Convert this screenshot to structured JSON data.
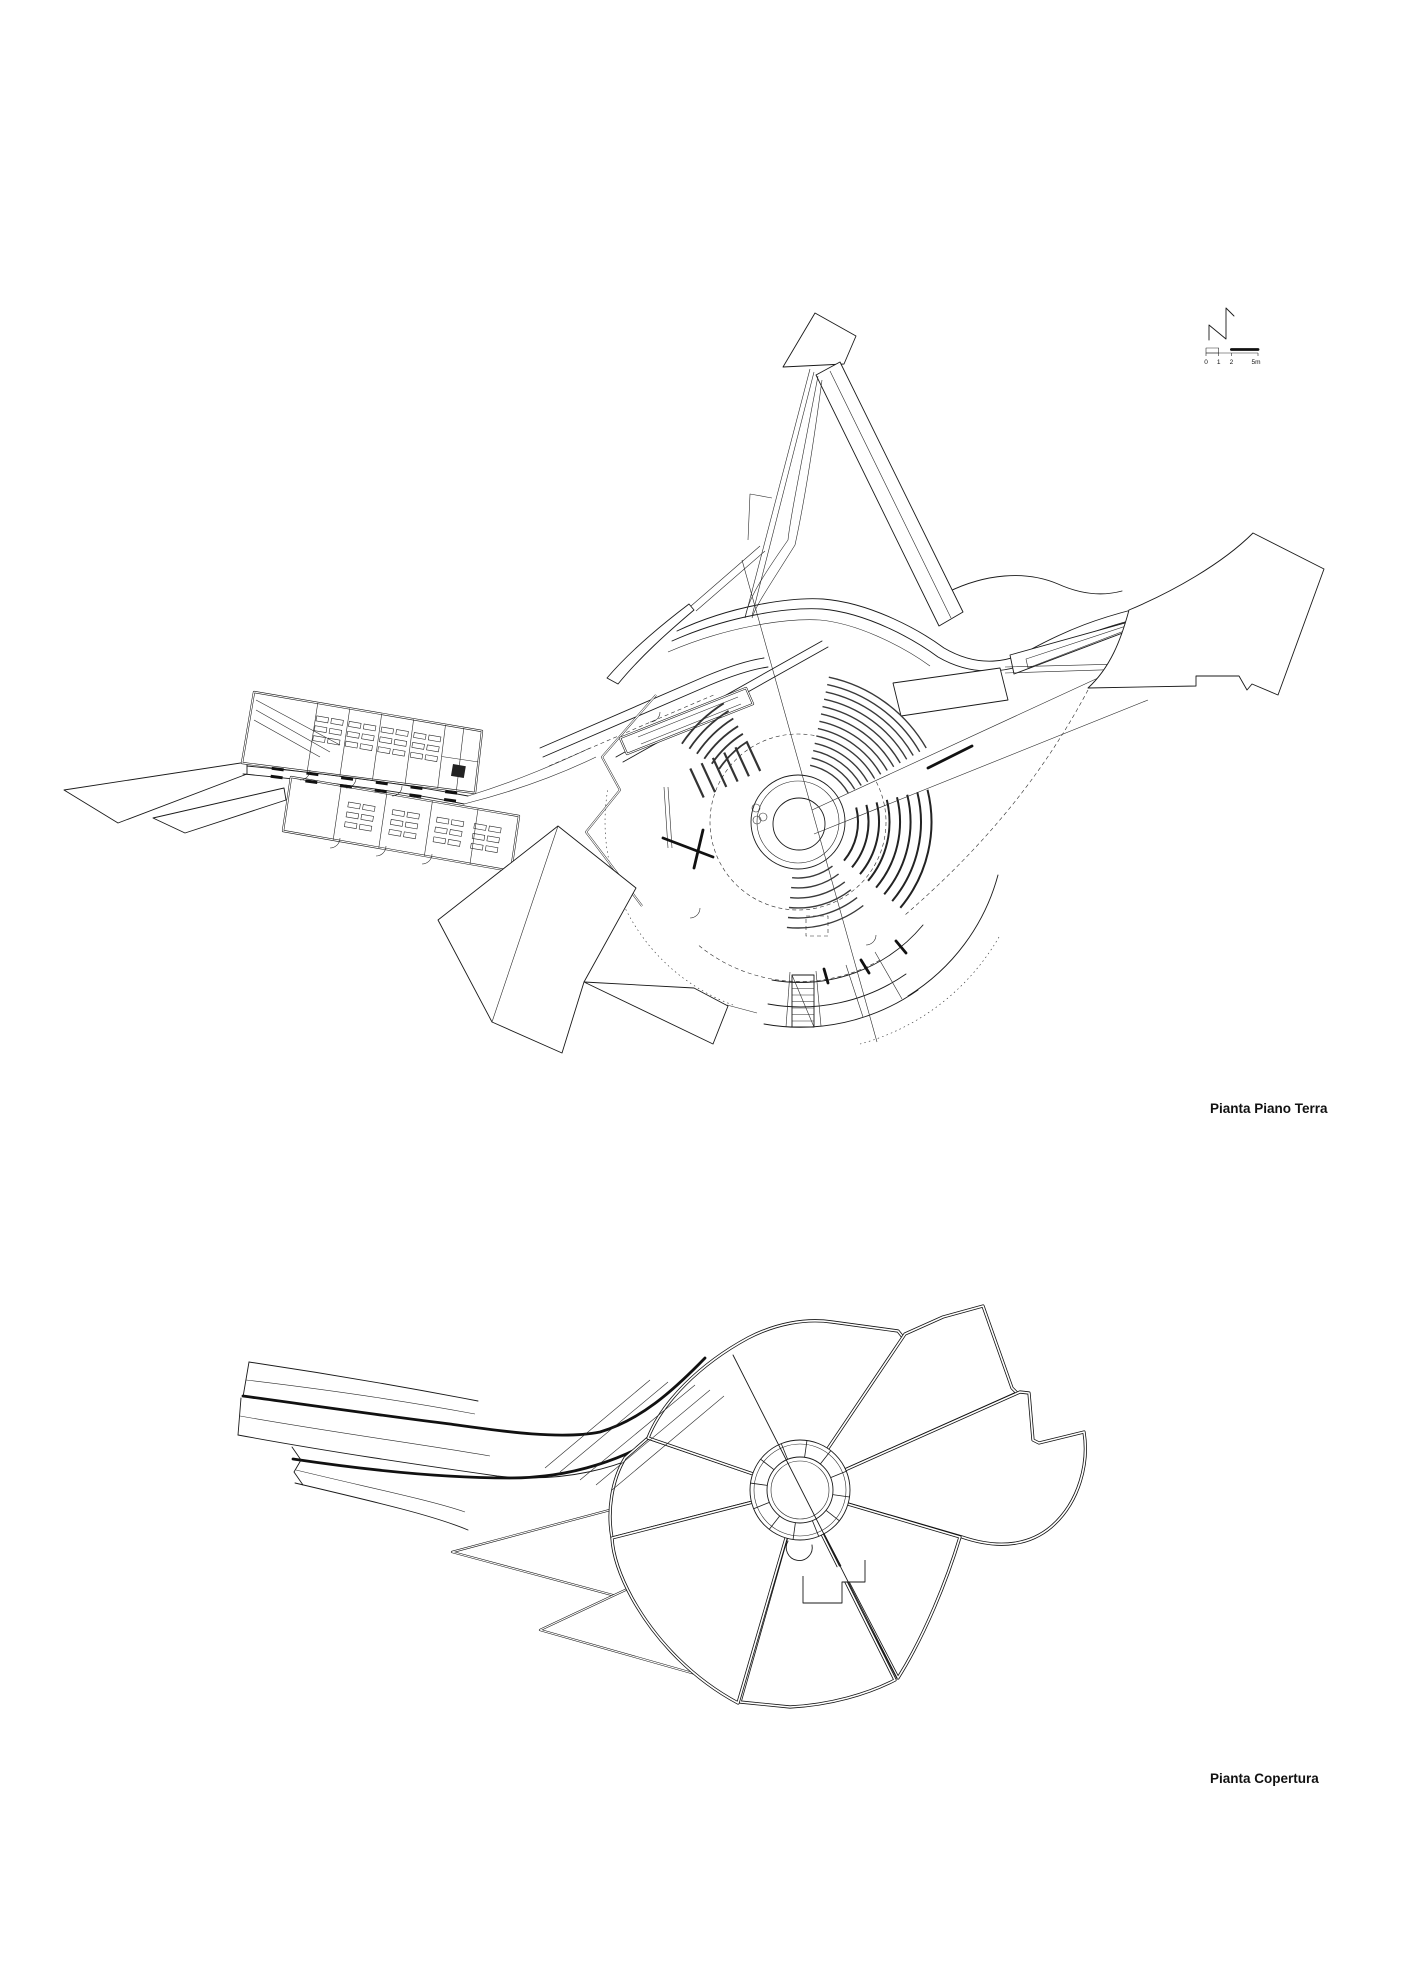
{
  "document": {
    "kind": "architectural plan sheet",
    "background_color": "#ffffff",
    "ink_color": "#1a1a1a"
  },
  "plans": {
    "ground": {
      "title": "Pianta Piano Terra"
    },
    "roof": {
      "title": "Pianta Copertura"
    }
  },
  "north_arrow": {
    "meaning": "north direction symbol"
  },
  "scale_bar": {
    "ticks": [
      "0",
      "1",
      "2"
    ],
    "end_label": "5m"
  }
}
